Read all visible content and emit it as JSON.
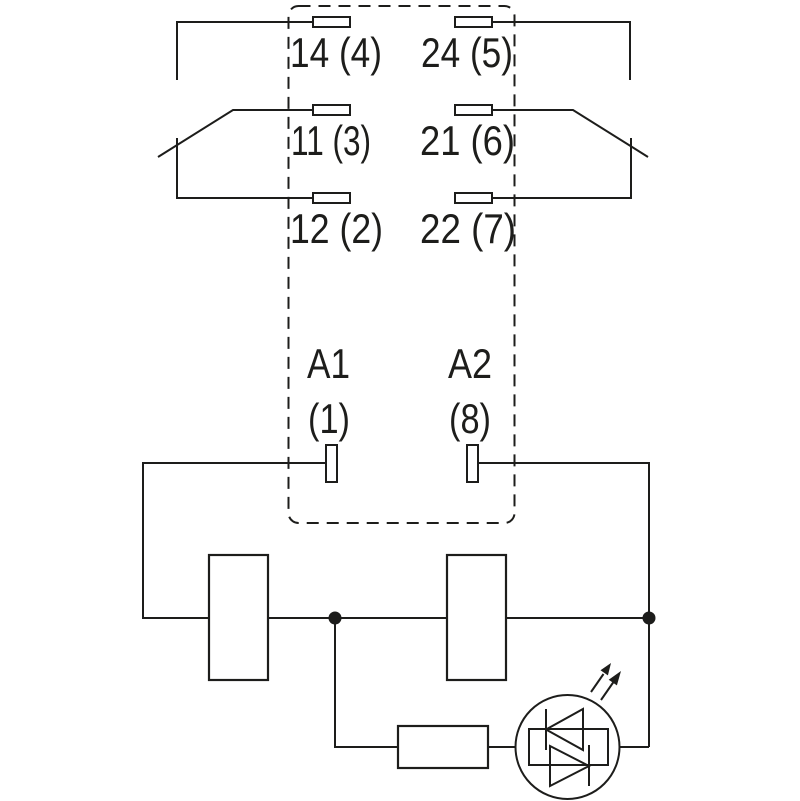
{
  "diagram": {
    "kind": "relay-contact-and-coil-wiring-schematic",
    "colors": {
      "background": "#ffffff",
      "line": "#1d1d1b",
      "text": "#1d1d1b"
    },
    "contact_labels": {
      "pole1_no": "14 (4)",
      "pole2_no": "24 (5)",
      "pole1_common": "11 (3)",
      "pole2_common": "21 (6)",
      "pole1_nc": "12 (2)",
      "pole2_nc": "22 (7)"
    },
    "coil_labels": {
      "a1": "A1",
      "a1_pin": "(1)",
      "a2": "A2",
      "a2_pin": "(8)"
    },
    "components": {
      "enclosure": "dashed-relay-outline",
      "terminals": "terminal-pad",
      "contacts": "changeover-contact-arm",
      "coil_modules": "coil-module-box",
      "junctions": "junction-dot",
      "resistor": "resistor",
      "indicator": "bidirectional-led-in-circle",
      "emission": "light-emission-arrows"
    }
  }
}
